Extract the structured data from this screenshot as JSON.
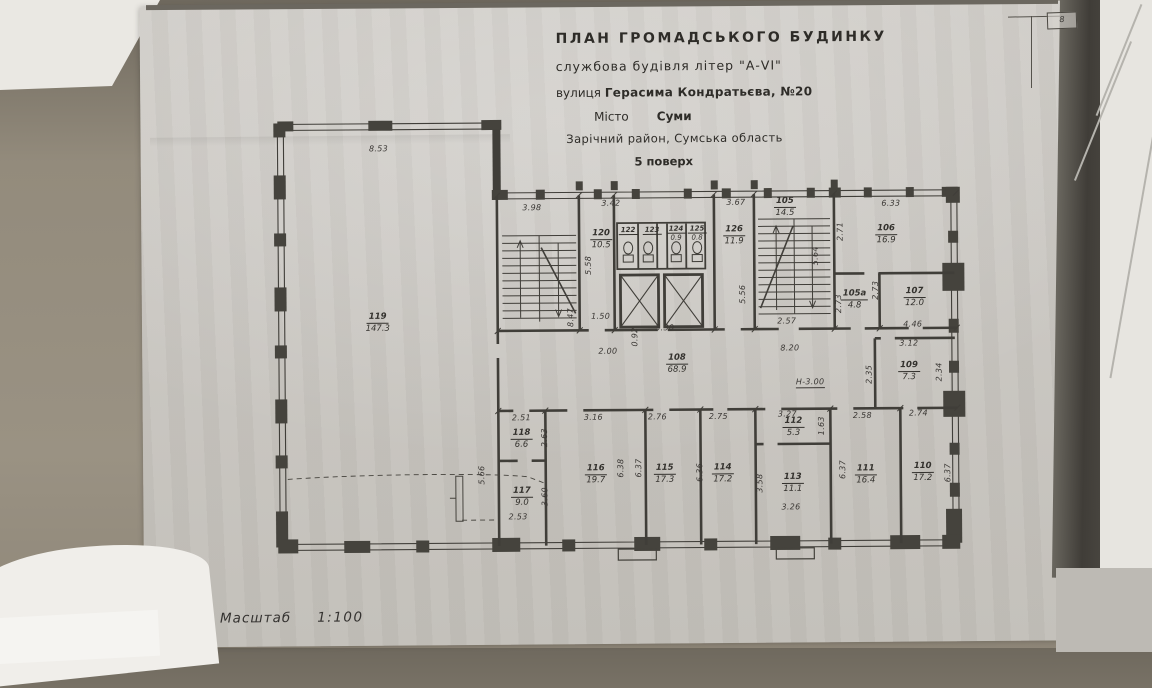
{
  "document": {
    "title_line1": "ПЛАН  ГРОМАДСЬКОГО  БУДИНКУ",
    "title_line2": "службова будівля літер \"А-VI\"",
    "address_prefix": "вулиця",
    "address": "Герасима Кондратьєва, №20",
    "city_prefix": "Місто",
    "city": "Суми",
    "district": "Зарічний район, Сумська область",
    "floor": "5 поверх",
    "scale_prefix": "Масштаб",
    "scale": "1:100",
    "height_mark": "Н-3.00",
    "corner_stamp": "8"
  },
  "rooms": {
    "r119": {
      "num": "119",
      "area": "147.3"
    },
    "r120": {
      "num": "120",
      "area": "10.5"
    },
    "r122": {
      "num": "122",
      "area": ""
    },
    "r123": {
      "num": "123",
      "area": ""
    },
    "r124": {
      "num": "124",
      "area": "0.9"
    },
    "r125": {
      "num": "125",
      "area": "0.8"
    },
    "r126": {
      "num": "126",
      "area": "11.9"
    },
    "r105": {
      "num": "105",
      "area": "14.5"
    },
    "r106": {
      "num": "106",
      "area": "16.9"
    },
    "r105a": {
      "num": "105а",
      "area": "4.8"
    },
    "r107": {
      "num": "107",
      "area": "12.0"
    },
    "r108": {
      "num": "108",
      "area": "68.9"
    },
    "r109": {
      "num": "109",
      "area": "7.3"
    },
    "r110": {
      "num": "110",
      "area": "17.2"
    },
    "r111": {
      "num": "111",
      "area": "16.4"
    },
    "r112": {
      "num": "112",
      "area": "5.3"
    },
    "r113": {
      "num": "113",
      "area": "11.1"
    },
    "r114": {
      "num": "114",
      "area": "17.2"
    },
    "r115": {
      "num": "115",
      "area": "17.3"
    },
    "r116": {
      "num": "116",
      "area": "19.7"
    },
    "r117": {
      "num": "117",
      "area": "9.0"
    },
    "r118": {
      "num": "118",
      "area": "6.6"
    }
  },
  "dims": {
    "d8_53": "8.53",
    "d3_98": "3.98",
    "d3_42": "3.42",
    "d3_67": "3.67",
    "d6_33": "6.33",
    "d1_50": "1.50",
    "d2_57": "2.57",
    "d2_00": "2.00",
    "d3_30": "3.30",
    "d8_20": "8.20",
    "d3_12": "3.12",
    "d4_46": "4.46",
    "d2_51": "2.51",
    "d3_16": "3.16",
    "d2_76": "2.76",
    "d2_75": "2.75",
    "d3_27": "3.27",
    "d2_58": "2.58",
    "d2_74": "2.74",
    "d2_53": "2.53",
    "d3_26": "3.26",
    "d8_47": "8.47",
    "d5_58": "5.58",
    "d5_56": "5.56",
    "d5_64": "5.64",
    "d2_71": "2.71",
    "d2_73a": "2.73",
    "d2_73b": "2.73",
    "d0_92": "0.92",
    "d2_35": "2.35",
    "d2_34": "2.34",
    "d2_63": "2.63",
    "d3_60": "3.60",
    "d5_66": "5.66",
    "d6_38": "6.38",
    "d6_37a": "6.37",
    "d6_36": "6.36",
    "d1_63": "1.63",
    "d3_58": "3.58",
    "d6_37b": "6.37",
    "d6_37c": "6.37"
  }
}
